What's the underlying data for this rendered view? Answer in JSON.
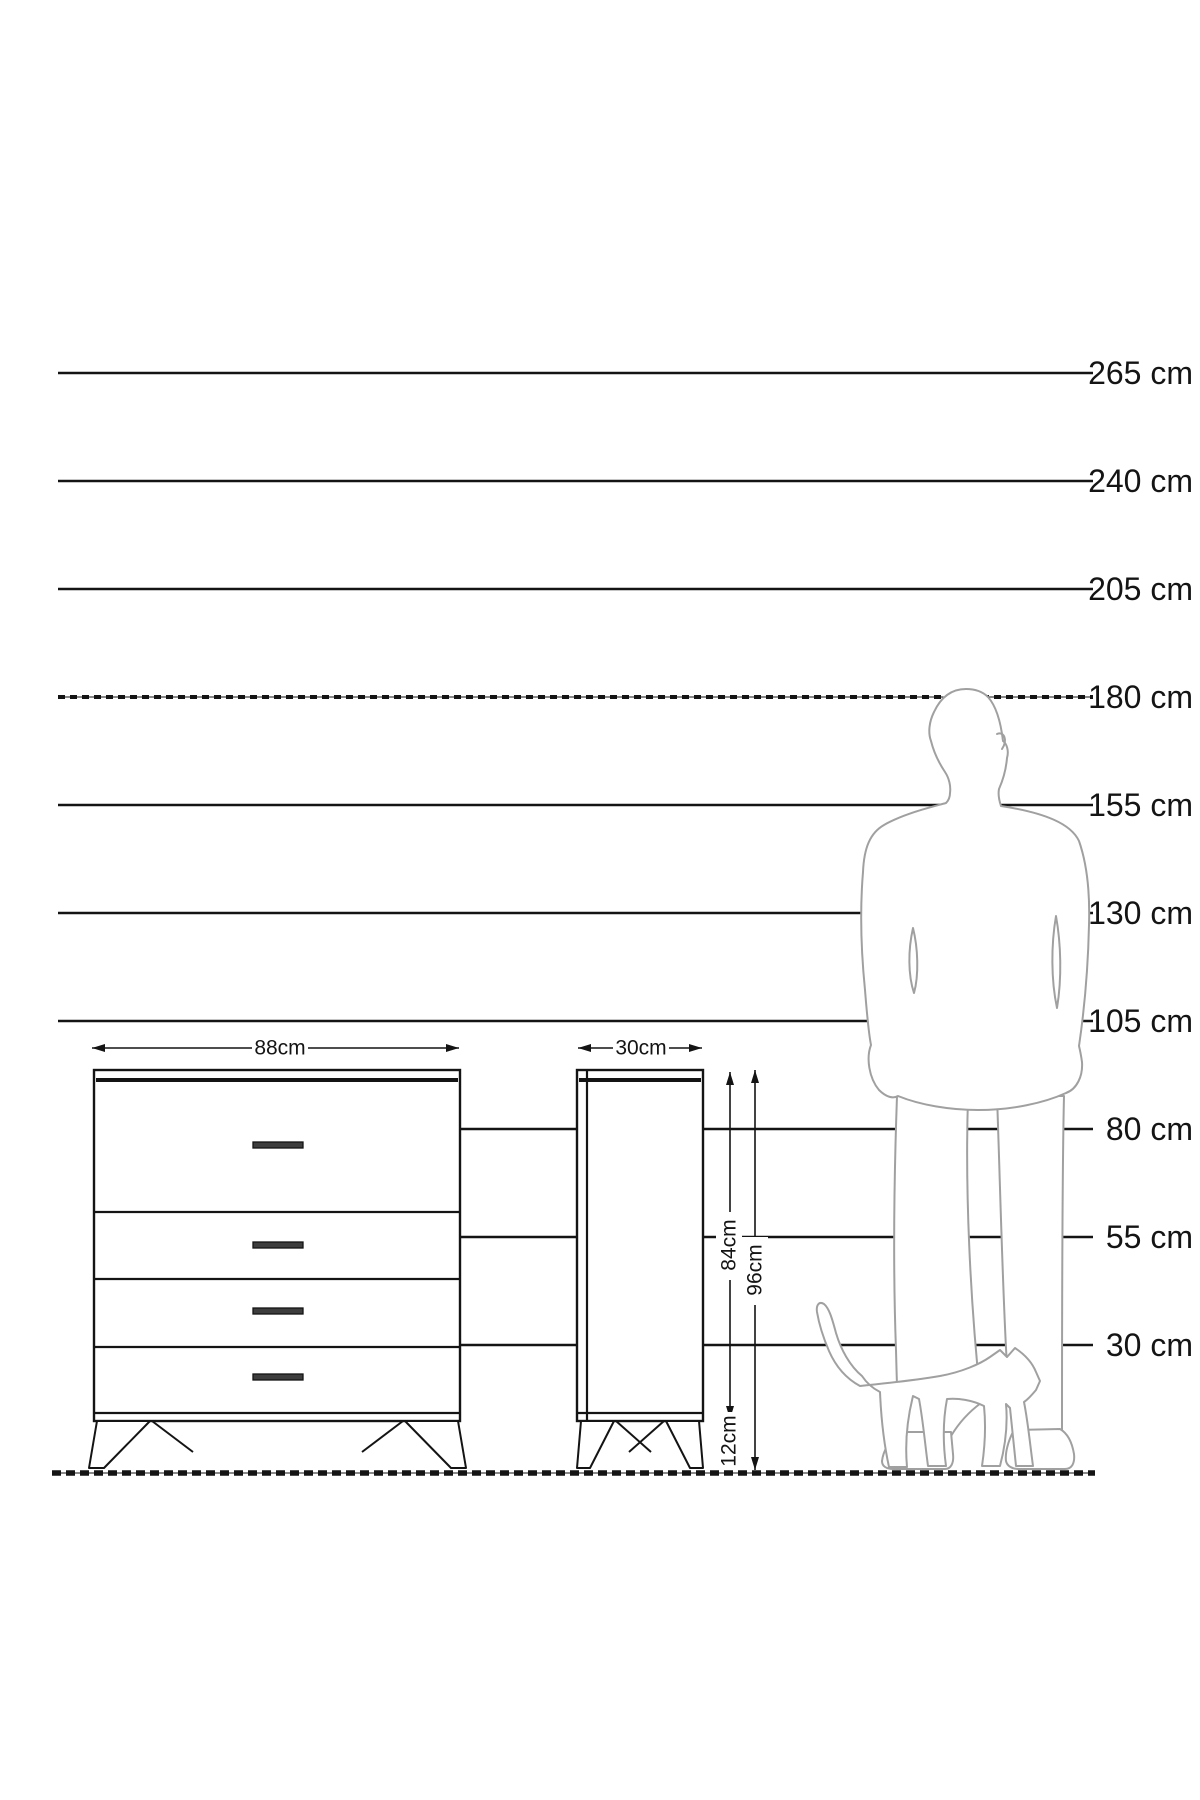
{
  "diagram": {
    "type": "furniture-size-guide",
    "unit": "cm"
  },
  "scale_labels": [
    "265 cm",
    "240 cm",
    "205 cm",
    "180 cm",
    "155 cm",
    "130 cm",
    "105 cm",
    "80 cm",
    "55 cm",
    "30 cm"
  ],
  "dimensions": {
    "front_width": "88cm",
    "side_depth": "30cm",
    "body_height": "84cm",
    "total_height": "96cm",
    "leg_height": "12cm"
  },
  "furniture": {
    "type": "chest-of-drawers",
    "views": [
      "front",
      "side"
    ],
    "drawer_count": 4,
    "width_cm": 88,
    "depth_cm": 30,
    "body_height_cm": 84,
    "total_height_cm": 96,
    "leg_height_cm": 12
  },
  "figures": {
    "person": "standing-man-silhouette",
    "cat": "walking-cat-silhouette"
  },
  "colors": {
    "background": "#ffffff",
    "line": "#141414",
    "silhouette": "#a0a0a0"
  }
}
